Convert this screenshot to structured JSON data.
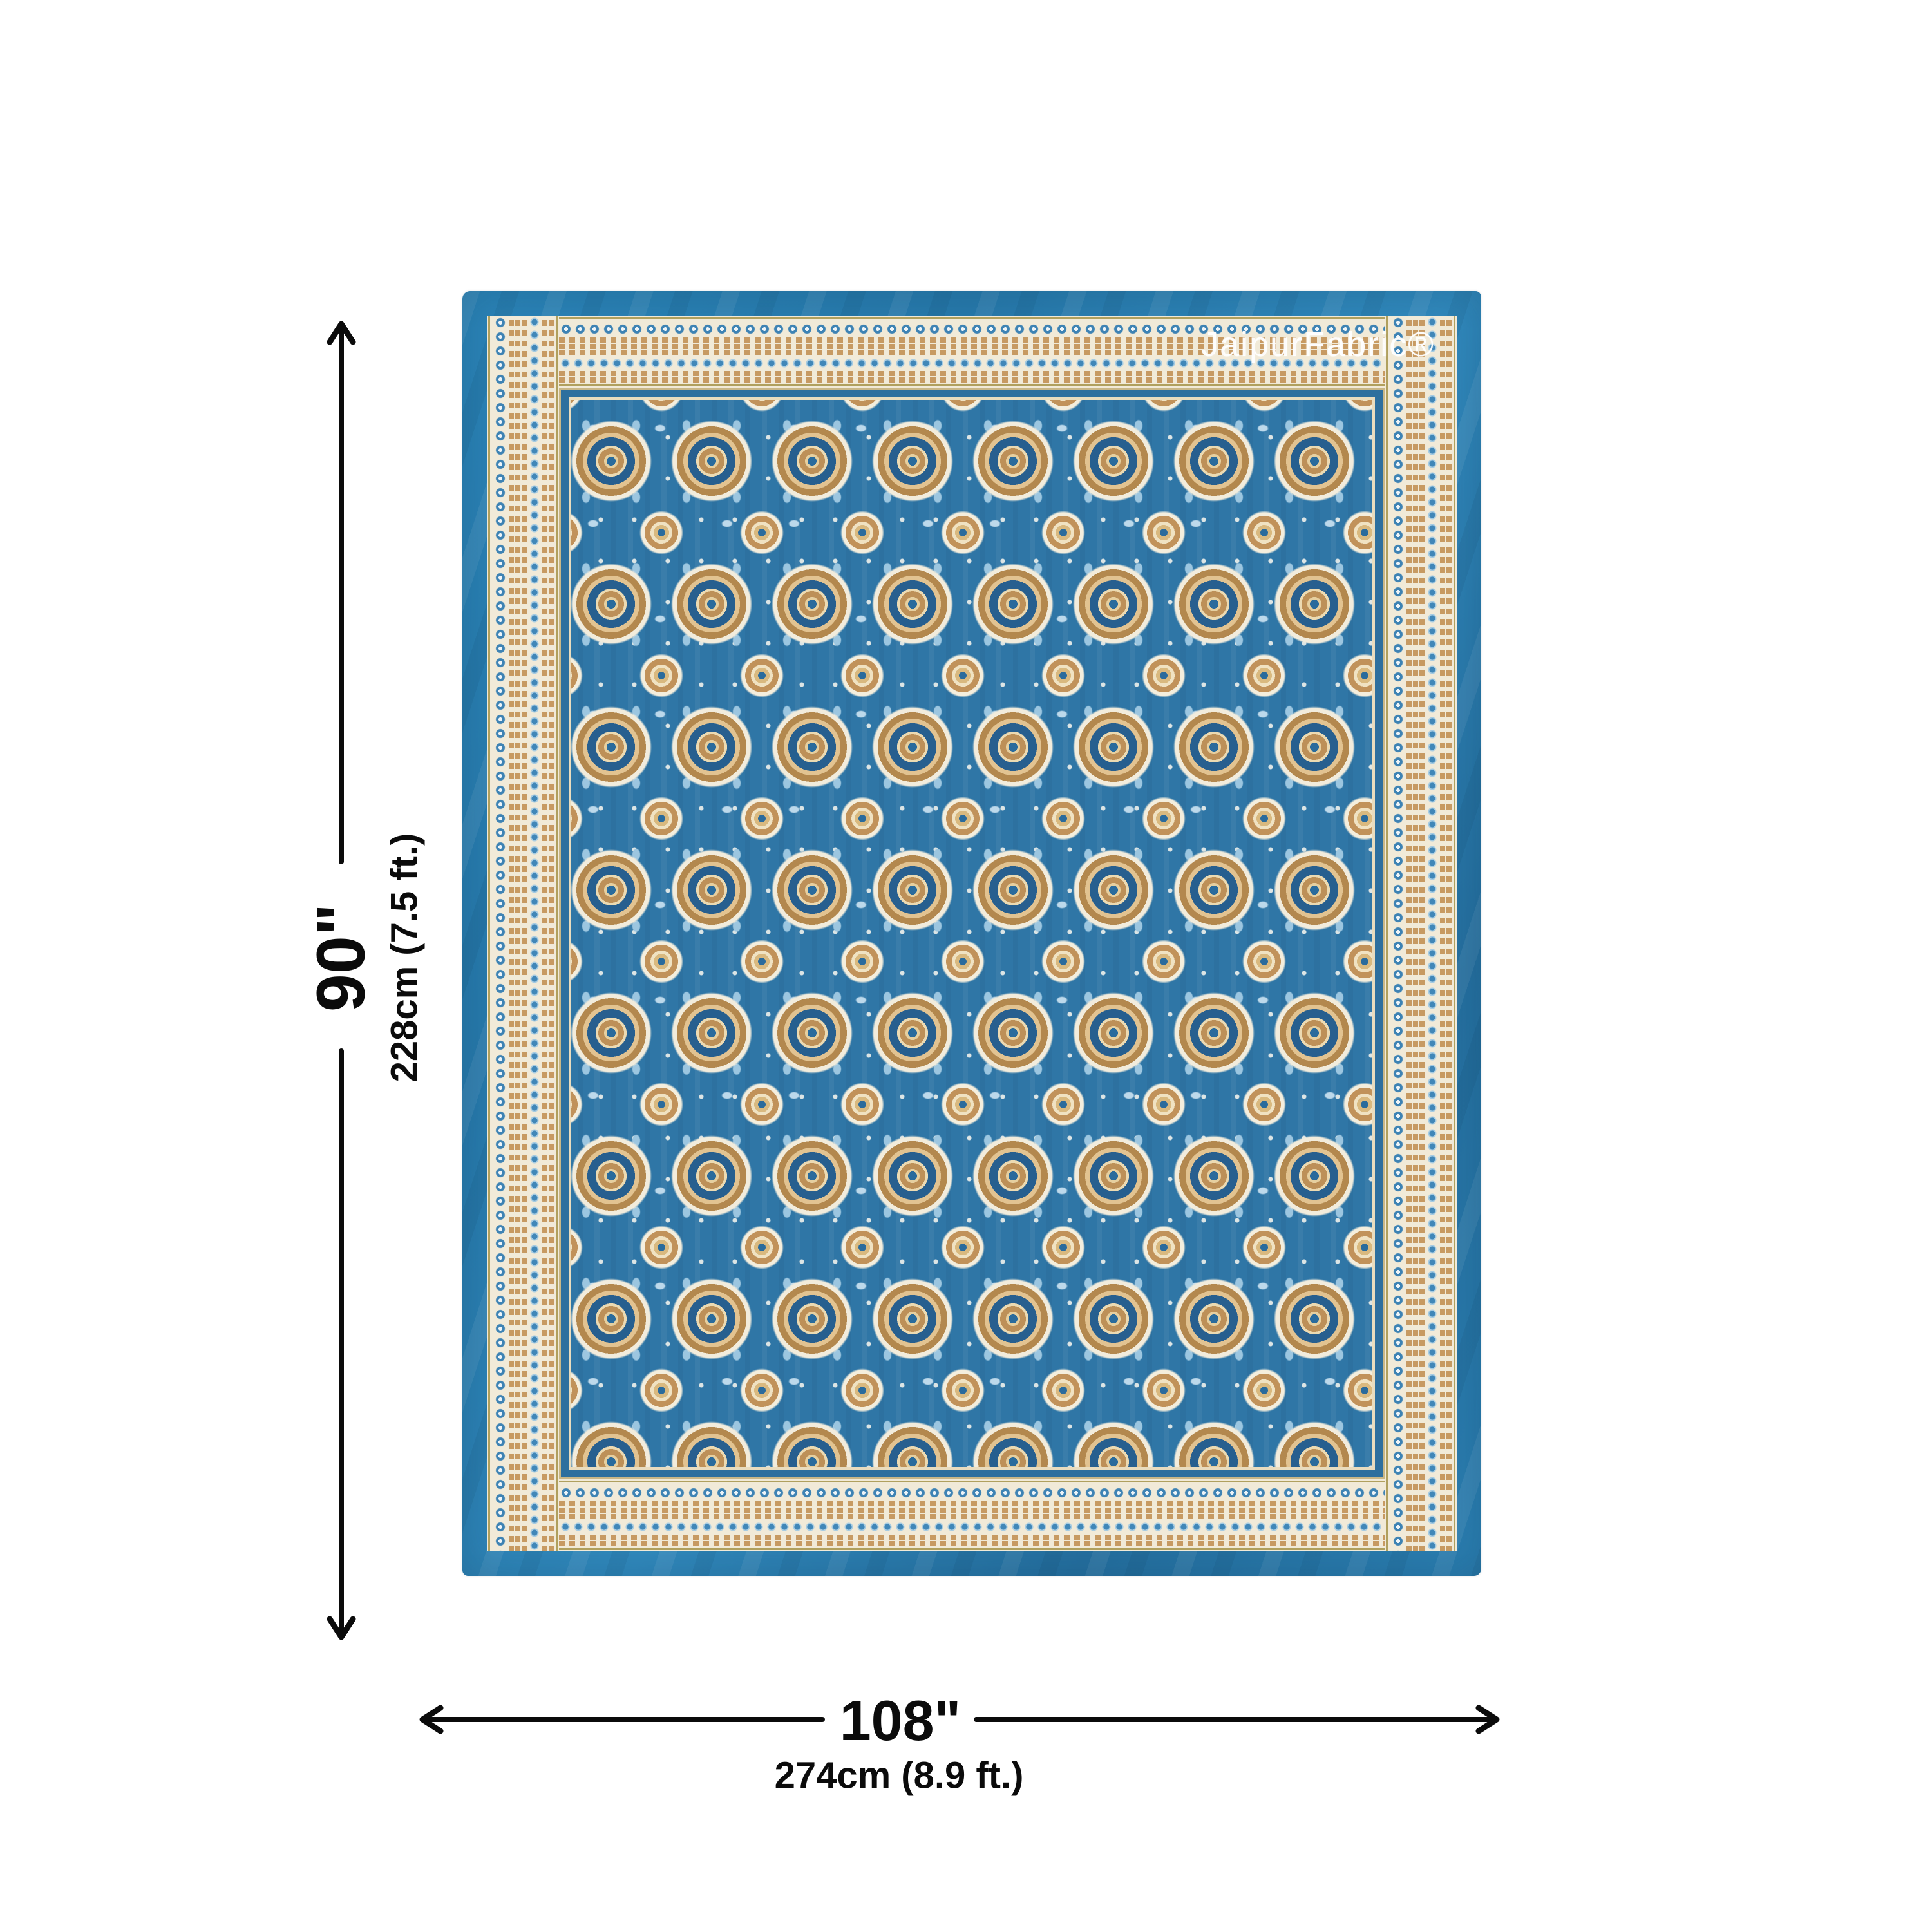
{
  "brand": {
    "watermark": "JaipurFabric®"
  },
  "dimension_labels": {
    "height_inches": "90\"",
    "height_metric": "228cm (7.5 ft.)",
    "width_inches": "108\"",
    "width_metric": "274cm (8.9 ft.)"
  },
  "icons": {
    "height_arrow": "double-headed-vertical-arrow",
    "width_arrow": "double-headed-horizontal-arrow"
  },
  "colors": {
    "page_background": "#ffffff",
    "fabric_border_blue": "#2b82b5",
    "field_blue": "#2f76a6",
    "band_cream": "#f1ead8",
    "motif_tan": "#c79a62",
    "motif_bronze": "#b3884e",
    "motif_dark_blue": "#275f8f",
    "light_blue_accent": "#9cc6e0",
    "annotation_black": "#0b0b0b",
    "watermark_white": "#ffffff"
  }
}
